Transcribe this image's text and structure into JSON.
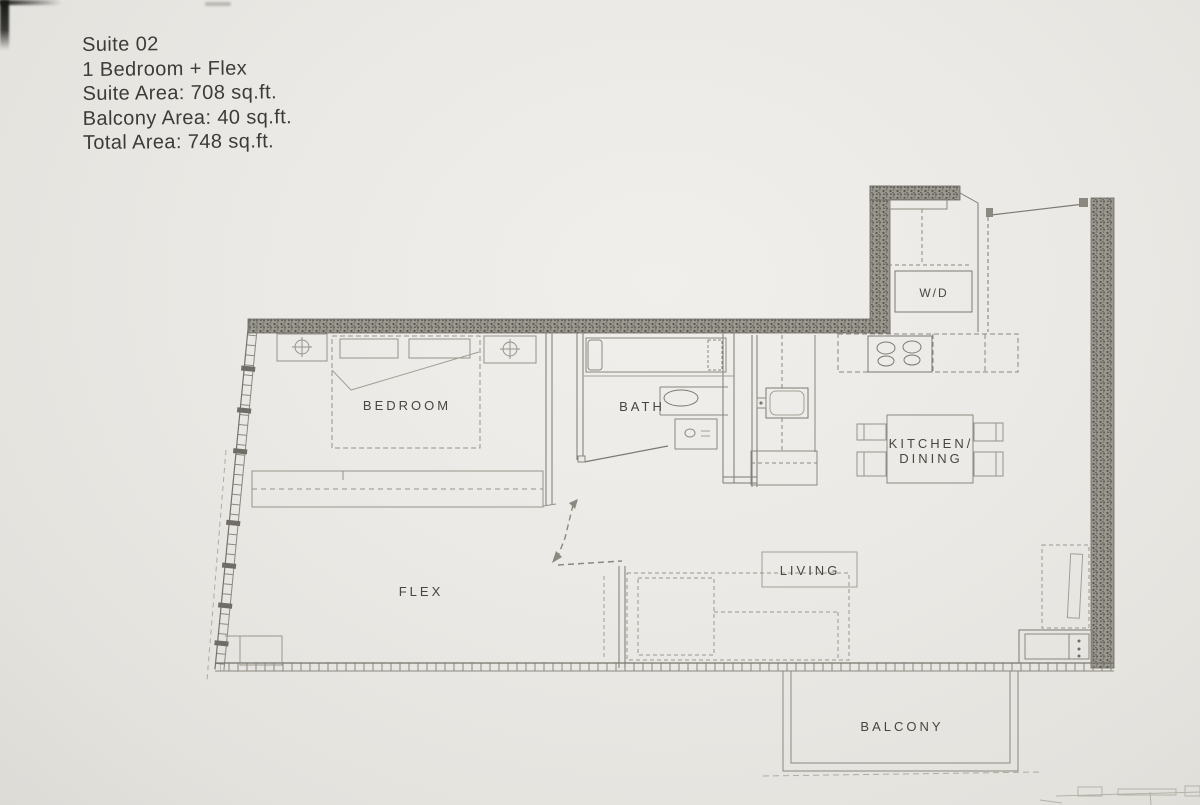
{
  "header": {
    "line1": "Suite 02",
    "line2": "1 Bedroom + Flex",
    "line3": "Suite Area: 708 sq.ft.",
    "line4": "Balcony Area: 40 sq.ft.",
    "line5": "Total Area: 748 sq.ft."
  },
  "rooms": {
    "bedroom": "BEDROOM",
    "bath": "BATH",
    "kitchen_line1": "KITCHEN/",
    "kitchen_line2": "DINING",
    "flex": "FLEX",
    "living": "LIVING",
    "balcony": "BALCONY",
    "washer_dryer": "W/D"
  },
  "colors": {
    "paper": "#ebe9e5",
    "ink": "#3c3b39",
    "wall_fill": "#96948d",
    "line_strong": "#6f6d66",
    "line_medium": "#8a887f",
    "line_light": "#a29f95"
  }
}
